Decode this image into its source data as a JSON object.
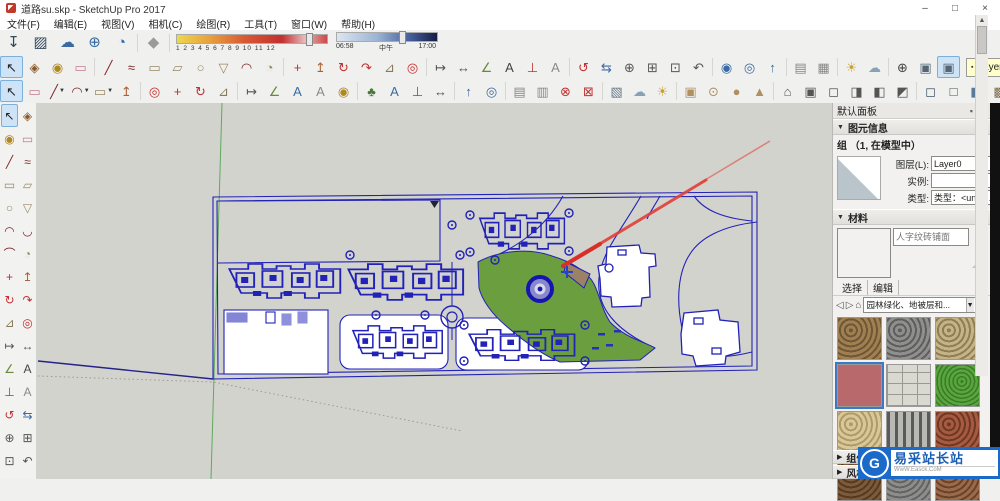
{
  "window": {
    "title": "道路su.skp - SketchUp Pro 2017",
    "controls": {
      "minimize": "–",
      "maximize": "□",
      "close": "×"
    }
  },
  "menu": {
    "items": [
      {
        "label": "文件(F)"
      },
      {
        "label": "编辑(E)"
      },
      {
        "label": "视图(V)"
      },
      {
        "label": "相机(C)"
      },
      {
        "label": "绘图(R)"
      },
      {
        "label": "工具(T)"
      },
      {
        "label": "窗口(W)"
      },
      {
        "label": "帮助(H)"
      }
    ]
  },
  "toolbar_top": {
    "icons": [
      {
        "n": "warehouse-download-icon",
        "g": "↧",
        "c": "#35495e"
      },
      {
        "n": "share-model-icon",
        "g": "▨",
        "c": "#35495e"
      },
      {
        "n": "upload-model-icon",
        "g": "☁",
        "c": "#3a6aa0"
      },
      {
        "n": "add-extension-icon",
        "g": "⊕",
        "c": "#3a6aa0"
      },
      {
        "n": "trimble-connect-icon",
        "g": "◔",
        "c": "#2a6ab0",
        "sep": true
      },
      {
        "n": "soften-edges-icon",
        "g": "◆",
        "c": "#9a9a96"
      }
    ],
    "shadow": {
      "months": "1 2 3 4 5 6 7 8 9 10 11 12",
      "month_handle_pct": 86,
      "time_start": "06:58",
      "time_noon": "中午",
      "time_end": "17:00",
      "time_handle_pct": 62
    }
  },
  "toolbar_row3": {
    "icons": [
      {
        "n": "select-icon",
        "g": "↖",
        "c": "#222222",
        "sel": true
      },
      {
        "n": "make-component-icon",
        "g": "◈",
        "c": "#8a5a2a"
      },
      {
        "n": "paint-bucket-icon",
        "g": "◉",
        "c": "#b08820"
      },
      {
        "n": "eraser-icon",
        "g": "▭",
        "c": "#c08090",
        "sep": true
      },
      {
        "n": "line-icon",
        "g": "╱",
        "c": "#7a2a2a"
      },
      {
        "n": "freehand-icon",
        "g": "≈",
        "c": "#7a2a2a"
      },
      {
        "n": "rectangle-icon",
        "g": "▭",
        "c": "#9a8a6a"
      },
      {
        "n": "rotated-rectangle-icon",
        "g": "▱",
        "c": "#9a8a6a"
      },
      {
        "n": "circle-icon",
        "g": "○",
        "c": "#9a8a6a"
      },
      {
        "n": "polygon-icon",
        "g": "▽",
        "c": "#9a8a6a"
      },
      {
        "n": "arc-icon",
        "g": "◠",
        "c": "#7a2a2a"
      },
      {
        "n": "pie-icon",
        "g": "◔",
        "c": "#9a8a6a",
        "sep": true
      },
      {
        "n": "move-icon",
        "g": "+",
        "c": "#c03030"
      },
      {
        "n": "push-pull-icon",
        "g": "↥",
        "c": "#b06030"
      },
      {
        "n": "rotate-icon",
        "g": "↻",
        "c": "#c03030"
      },
      {
        "n": "follow-me-icon",
        "g": "↷",
        "c": "#c03030"
      },
      {
        "n": "scale-icon",
        "g": "⊿",
        "c": "#8a7a5a"
      },
      {
        "n": "offset-icon",
        "g": "◎",
        "c": "#c03030",
        "sep": true
      },
      {
        "n": "tape-measure-icon",
        "g": "↦",
        "c": "#555555"
      },
      {
        "n": "dimension-icon",
        "g": "↔",
        "c": "#555555"
      },
      {
        "n": "protractor-icon",
        "g": "∠",
        "c": "#6a8a3a"
      },
      {
        "n": "text-icon",
        "g": "A",
        "c": "#444444"
      },
      {
        "n": "axes-icon",
        "g": "⊥",
        "c": "#c03030"
      },
      {
        "n": "3d-text-icon",
        "g": "A",
        "c": "#8a8a8a",
        "sep": true
      },
      {
        "n": "orbit-icon",
        "g": "↺",
        "c": "#c03030"
      },
      {
        "n": "pan-icon",
        "g": "⇆",
        "c": "#3a6aa0"
      },
      {
        "n": "zoom-icon",
        "g": "⊕",
        "c": "#555555"
      },
      {
        "n": "zoom-window-icon",
        "g": "⊞",
        "c": "#555555"
      },
      {
        "n": "zoom-extents-icon",
        "g": "⊡",
        "c": "#555555"
      },
      {
        "n": "previous-view-icon",
        "g": "↶",
        "c": "#555555",
        "sep": true
      },
      {
        "n": "position-camera-icon",
        "g": "◉",
        "c": "#3a6aa0"
      },
      {
        "n": "look-around-icon",
        "g": "◎",
        "c": "#3a6aa0"
      },
      {
        "n": "walk-icon",
        "g": "↑",
        "c": "#3a6aa0",
        "sep": true
      },
      {
        "n": "section-plane-icon",
        "g": "▤",
        "c": "#888888"
      },
      {
        "n": "section-fill-icon",
        "g": "▦",
        "c": "#888888",
        "sep": true
      },
      {
        "n": "shadows-icon",
        "g": "☀",
        "c": "#c8a030"
      },
      {
        "n": "fog-icon",
        "g": "☁",
        "c": "#88a0b8",
        "sep": true
      },
      {
        "n": "compass-icon",
        "g": "⊕",
        "c": "#444444"
      },
      {
        "n": "view-cube-icon",
        "g": "▣",
        "c": "#556677"
      },
      {
        "n": "view-cube-shaded-icon",
        "g": "▣",
        "c": "#556677",
        "sel": true
      }
    ],
    "layer_dropdown": {
      "value": "Layer0"
    }
  },
  "toolbar_row4": {
    "icons": [
      {
        "n": "select-icon",
        "g": "↖",
        "c": "#222222",
        "sel": true
      },
      {
        "n": "eraser-icon",
        "g": "▭",
        "c": "#c08090"
      },
      {
        "n": "line-icon",
        "g": "╱",
        "c": "#7a2a2a",
        "caret": true
      },
      {
        "n": "arc-icon",
        "g": "◠",
        "c": "#7a2a2a",
        "caret": true
      },
      {
        "n": "rectangle-icon",
        "g": "▭",
        "c": "#9a8a6a",
        "caret": true
      },
      {
        "n": "push-pull-icon",
        "g": "↥",
        "c": "#b06030",
        "sep": true
      },
      {
        "n": "offset-icon",
        "g": "◎",
        "c": "#c03030"
      },
      {
        "n": "move-icon",
        "g": "+",
        "c": "#c03030"
      },
      {
        "n": "rotate-icon",
        "g": "↻",
        "c": "#c03030"
      },
      {
        "n": "scale-icon",
        "g": "⊿",
        "c": "#8a7a5a",
        "sep": true
      },
      {
        "n": "tape-measure-icon",
        "g": "↦",
        "c": "#555555"
      },
      {
        "n": "protractor-icon",
        "g": "∠",
        "c": "#6a8a3a"
      },
      {
        "n": "text-icon",
        "g": "A",
        "c": "#3a6aa0"
      },
      {
        "n": "3d-text-icon",
        "g": "A",
        "c": "#8a8a8a"
      },
      {
        "n": "paint-bucket-icon",
        "g": "◉",
        "c": "#b08820",
        "sep": true
      },
      {
        "n": "vegetation-icon",
        "g": "♣",
        "c": "#4a7a3a"
      },
      {
        "n": "label-icon",
        "g": "A",
        "c": "#3a6aa0"
      },
      {
        "n": "axes-icon",
        "g": "⊥",
        "c": "#c03030"
      },
      {
        "n": "dimension-icon",
        "g": "↔",
        "c": "#555555",
        "sep": true
      },
      {
        "n": "walk-icon",
        "g": "↑",
        "c": "#3a6aa0"
      },
      {
        "n": "look-around-icon",
        "g": "◎",
        "c": "#3a6aa0",
        "sep": true
      },
      {
        "n": "section-plane-icon",
        "g": "▤",
        "c": "#888888"
      },
      {
        "n": "section-cut-icon",
        "g": "▥",
        "c": "#888888"
      },
      {
        "n": "delete-guides-icon",
        "g": "⊗",
        "c": "#c03030"
      },
      {
        "n": "hide-rest-icon",
        "g": "⊠",
        "c": "#c03030",
        "sep": true
      },
      {
        "n": "scenes-icon",
        "g": "▧",
        "c": "#667788"
      },
      {
        "n": "fog-icon",
        "g": "☁",
        "c": "#88a0b8"
      },
      {
        "n": "shadows-icon",
        "g": "☀",
        "c": "#c8a030",
        "sep": true
      },
      {
        "n": "shape-box-icon",
        "g": "▣",
        "c": "#b09060"
      },
      {
        "n": "shape-cylinder-icon",
        "g": "⊙",
        "c": "#b09060"
      },
      {
        "n": "shape-sphere-icon",
        "g": "●",
        "c": "#b09060"
      },
      {
        "n": "shape-cone-icon",
        "g": "▲",
        "c": "#b09060",
        "sep": true
      },
      {
        "n": "view-iso-icon",
        "g": "⌂",
        "c": "#555555"
      },
      {
        "n": "view-top-icon",
        "g": "▣",
        "c": "#555555"
      },
      {
        "n": "view-front-icon",
        "g": "◻",
        "c": "#555555"
      },
      {
        "n": "view-right-icon",
        "g": "◨",
        "c": "#555555"
      },
      {
        "n": "view-back-icon",
        "g": "◧",
        "c": "#555555"
      },
      {
        "n": "view-left-icon",
        "g": "◩",
        "c": "#555555",
        "sep": true
      },
      {
        "n": "style-wireframe-icon",
        "g": "◻",
        "c": "#445566"
      },
      {
        "n": "style-hidden-line-icon",
        "g": "□",
        "c": "#445566"
      },
      {
        "n": "style-shaded-icon",
        "g": "◧",
        "c": "#5a7a9a"
      },
      {
        "n": "style-textured-icon",
        "g": "▩",
        "c": "#7a6a4a"
      },
      {
        "n": "style-monochrome-icon",
        "g": "◐",
        "c": "#666666"
      },
      {
        "n": "style-xray-icon",
        "g": "▨",
        "c": "#8899aa",
        "sep": true
      },
      {
        "n": "warehouse-icon",
        "g": "↧",
        "c": "#334455"
      },
      {
        "n": "extension-warehouse-icon",
        "g": "⊞",
        "c": "#334455"
      }
    ]
  },
  "left_palette": {
    "rows": [
      [
        {
          "n": "select-icon",
          "g": "↖",
          "c": "#222222",
          "sel": true
        },
        {
          "n": "make-component-icon",
          "g": "◈",
          "c": "#8a5a2a"
        }
      ],
      [
        {
          "n": "paint-bucket-icon",
          "g": "◉",
          "c": "#b08820"
        },
        {
          "n": "eraser-icon",
          "g": "▭",
          "c": "#c08090"
        }
      ],
      [
        {
          "n": "line-icon",
          "g": "╱",
          "c": "#7a2a2a"
        },
        {
          "n": "freehand-icon",
          "g": "≈",
          "c": "#7a2a2a"
        }
      ],
      [
        {
          "n": "rectangle-icon",
          "g": "▭",
          "c": "#9a8a6a"
        },
        {
          "n": "rotated-rectangle-icon",
          "g": "▱",
          "c": "#9a8a6a"
        }
      ],
      [
        {
          "n": "circle-icon",
          "g": "○",
          "c": "#9a8a6a"
        },
        {
          "n": "polygon-icon",
          "g": "▽",
          "c": "#9a8a6a"
        }
      ],
      [
        {
          "n": "arc-icon",
          "g": "◠",
          "c": "#7a2a2a"
        },
        {
          "n": "two-point-arc-icon",
          "g": "◡",
          "c": "#7a2a2a"
        }
      ],
      [
        {
          "n": "three-point-arc-icon",
          "g": "⌒",
          "c": "#7a2a2a"
        },
        {
          "n": "pie-icon",
          "g": "◔",
          "c": "#9a8a6a"
        }
      ],
      [
        {
          "n": "move-icon",
          "g": "+",
          "c": "#c03030"
        },
        {
          "n": "push-pull-icon",
          "g": "↥",
          "c": "#b06030"
        }
      ],
      [
        {
          "n": "rotate-icon",
          "g": "↻",
          "c": "#c03030"
        },
        {
          "n": "follow-me-icon",
          "g": "↷",
          "c": "#c03030"
        }
      ],
      [
        {
          "n": "scale-icon",
          "g": "⊿",
          "c": "#8a7a5a"
        },
        {
          "n": "offset-icon",
          "g": "◎",
          "c": "#c03030"
        }
      ],
      [
        {
          "n": "tape-measure-icon",
          "g": "↦",
          "c": "#555555"
        },
        {
          "n": "dimension-icon",
          "g": "↔",
          "c": "#555555"
        }
      ],
      [
        {
          "n": "protractor-icon",
          "g": "∠",
          "c": "#6a8a3a"
        },
        {
          "n": "text-icon",
          "g": "A",
          "c": "#444444"
        }
      ],
      [
        {
          "n": "axes-icon",
          "g": "⊥",
          "c": "#c03030"
        },
        {
          "n": "3d-text-icon",
          "g": "A",
          "c": "#8a8a8a"
        }
      ],
      [
        {
          "n": "orbit-icon",
          "g": "↺",
          "c": "#c03030"
        },
        {
          "n": "pan-icon",
          "g": "⇆",
          "c": "#3a6aa0"
        }
      ],
      [
        {
          "n": "zoom-icon",
          "g": "⊕",
          "c": "#555555"
        },
        {
          "n": "zoom-window-icon",
          "g": "⊞",
          "c": "#555555"
        }
      ],
      [
        {
          "n": "zoom-extents-icon",
          "g": "⊡",
          "c": "#555555"
        },
        {
          "n": "previous-view-icon",
          "g": "↶",
          "c": "#555555"
        }
      ]
    ]
  },
  "panel": {
    "title": "默认面板",
    "entity_info": {
      "header": "图元信息",
      "summary": "组 （1, 在模型中）",
      "layer_label": "图层(L):",
      "layer_value": "Layer0",
      "instance_label": "实例:",
      "instance_value": "",
      "type_label": "类型:",
      "type_value": "类型：<unde..."
    },
    "materials": {
      "header": "材料",
      "name": "人字纹砖铺面",
      "tabs": [
        {
          "label": "选择"
        },
        {
          "label": "编辑"
        }
      ],
      "category": "园林绿化、地被层和...",
      "swatches": [
        {
          "n": "swatch-brown-gravel",
          "t": "pebble",
          "c1": "#a08050",
          "c2": "#6e5636"
        },
        {
          "n": "swatch-gray-gravel",
          "t": "pebble",
          "c1": "#8f8f8d",
          "c2": "#5e5e5c"
        },
        {
          "n": "swatch-tan-rock",
          "t": "pebble",
          "c1": "#c4b387",
          "c2": "#8e7d55"
        },
        {
          "n": "swatch-red-brick",
          "t": "solid",
          "c1": "#b8696b",
          "c2": "#b8696b",
          "sel": true
        },
        {
          "n": "swatch-pavers",
          "t": "paver",
          "c1": "#d9d9d2",
          "c2": "#9a9a90"
        },
        {
          "n": "swatch-grass",
          "t": "grass",
          "c1": "#57a63e",
          "c2": "#3c7a28"
        },
        {
          "n": "swatch-sand",
          "t": "pebble",
          "c1": "#d8c79b",
          "c2": "#b09a66"
        },
        {
          "n": "swatch-fence",
          "t": "fence",
          "c1": "#b8b8b4",
          "c2": "#5a5a58"
        },
        {
          "n": "swatch-redbrown-gravel",
          "t": "pebble",
          "c1": "#a65a40",
          "c2": "#6e3826"
        },
        {
          "n": "swatch-dark-brown",
          "t": "pebble",
          "c1": "#7d5a3a",
          "c2": "#553a22"
        },
        {
          "n": "swatch-gray2",
          "t": "pebble",
          "c1": "#8d8d8b",
          "c2": "#636361"
        },
        {
          "n": "swatch-brown2",
          "t": "pebble",
          "c1": "#9a6a4a",
          "c2": "#6a4228"
        }
      ]
    },
    "collapsed": [
      {
        "label": "组件"
      },
      {
        "label": "风格"
      }
    ]
  },
  "watermark": {
    "logo": "G",
    "text": "易采站长站",
    "subtext": "WwW.Easck.CoM"
  },
  "canvas": {
    "colors": {
      "background": "#d3d3cd",
      "cad_line": "#2222b8",
      "grass": "#6b9e3e",
      "wedge": "#9b8266",
      "red_line": "#e04038",
      "axis_green": "#3a9a3a",
      "axis_blue": "#23238a",
      "guide_dotted": "#9a9a92"
    }
  }
}
